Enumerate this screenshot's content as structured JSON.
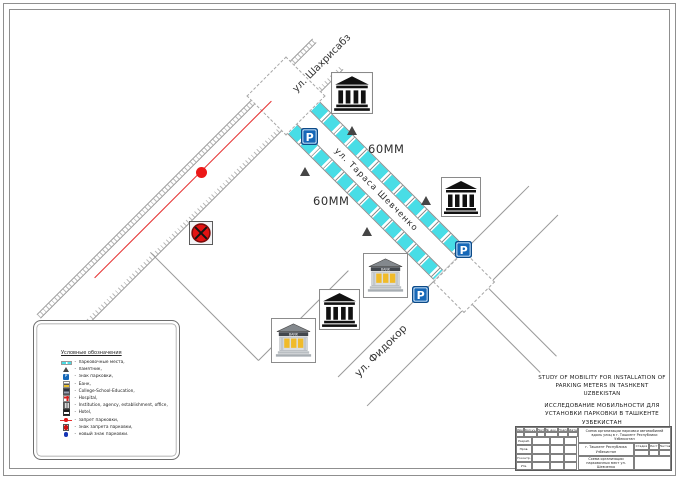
{
  "drawing": {
    "title_en": "STUDY OF MOBILITY FOR INSTALLATION OF PARKING METERS IN TASHKENT UZBEKISTAN",
    "title_ru": "ИССЛЕДОВАНИЕ МОБИЛЬНОСТИ ДЛЯ УСТАНОВКИ ПАРКОВКИ В ТАШКЕНТЕ УЗБЕКИСТАН"
  },
  "streets": {
    "shevchenko": "ул. Тараса Шевченко",
    "shakhrisabz": "ул. Шахрисабз",
    "fidokor": "ул. Фидокор"
  },
  "dimensions": {
    "top": "60MM",
    "bottom": "60MM"
  },
  "legend": {
    "title": "Условные обозначения",
    "separator": "-",
    "items": [
      {
        "icon": "parking-bay-icon",
        "label": "парковочные места,"
      },
      {
        "icon": "monument-icon",
        "label": "памятник,"
      },
      {
        "icon": "parking-sign-icon",
        "label": "знак парковки,"
      },
      {
        "icon": "bank-icon",
        "label": "Банк,"
      },
      {
        "icon": "education-icon",
        "label": "College-School-Education,"
      },
      {
        "icon": "hospital-icon",
        "label": "Hospital,"
      },
      {
        "icon": "institution-icon",
        "label": "Institution, agency, establishment, office,"
      },
      {
        "icon": "hotel-icon",
        "label": "Hotel,"
      },
      {
        "icon": "no-parking-line-icon",
        "label": "запрет парковки,"
      },
      {
        "icon": "no-parking-sign-icon",
        "label": "знак запрета парковки,"
      },
      {
        "icon": "new-parking-sign-icon",
        "label": "новый знак парковки."
      }
    ]
  },
  "markers": [
    {
      "type": "building-black",
      "x": 331,
      "y": 72,
      "size": 42
    },
    {
      "type": "building-black",
      "x": 441,
      "y": 177,
      "size": 40
    },
    {
      "type": "building-black",
      "x": 319,
      "y": 289,
      "size": 41
    },
    {
      "type": "building-bank",
      "x": 363,
      "y": 253,
      "size": 45
    },
    {
      "type": "building-bank",
      "x": 271,
      "y": 318,
      "size": 45
    },
    {
      "type": "parking-sign",
      "x": 301,
      "y": 128,
      "size": 17
    },
    {
      "type": "parking-sign",
      "x": 455,
      "y": 241,
      "size": 17
    },
    {
      "type": "parking-sign",
      "x": 412,
      "y": 286,
      "size": 17
    },
    {
      "type": "no-stopping-sign",
      "x": 189,
      "y": 221,
      "size": 24
    },
    {
      "type": "monument",
      "x": 347,
      "y": 126
    },
    {
      "type": "monument",
      "x": 300,
      "y": 167
    },
    {
      "type": "monument",
      "x": 362,
      "y": 227
    },
    {
      "type": "monument",
      "x": 421,
      "y": 196
    },
    {
      "type": "red-dot",
      "x": 196,
      "y": 167
    }
  ],
  "titleblock": {
    "header_cols": [
      "Изм.",
      "Кол.уч.",
      "Лист",
      "№ док.",
      "Подп.",
      "Дата"
    ],
    "roles": [
      "Разраб.",
      "Пров.",
      "Н.контр.",
      "Утв."
    ],
    "doc_title": "Схема организации парковки автомобилей вдоль улиц в г. Ташкент Республики Узбекистан",
    "org": "г. Ташкент Республика Узбекистан",
    "sheet_title": "Схема организации парковочных мест ул. Шевченко",
    "stage_cols": [
      "Стадия",
      "Лист",
      "Листов"
    ]
  },
  "colors": {
    "parking_bay": "#48dde6",
    "road_line": "#9a9a9a",
    "no_parking_red": "#e53030",
    "parking_sign_blue": "#1668b8"
  }
}
